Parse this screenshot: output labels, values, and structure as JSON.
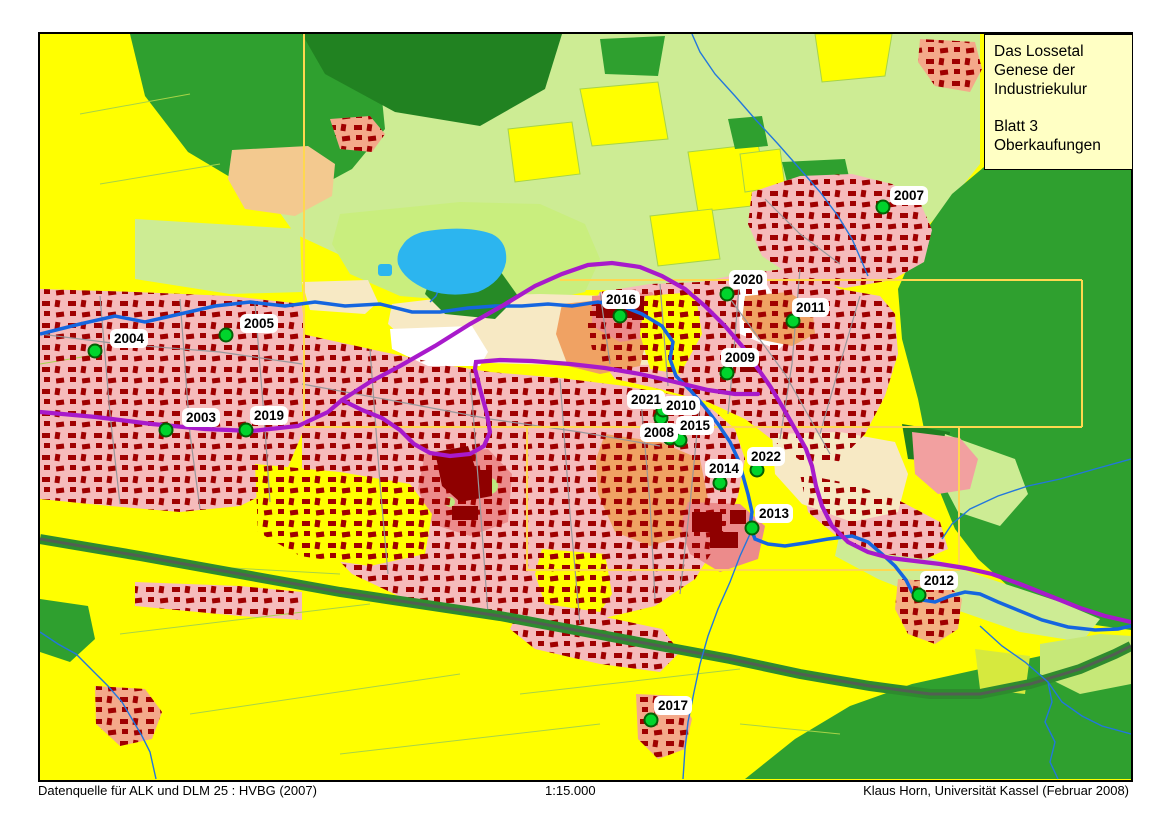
{
  "title_box": {
    "line1": "Das Lossetal",
    "line2": "Genese der",
    "line3": "Industriekulur",
    "line4": "Blatt 3",
    "line5": "Oberkaufungen"
  },
  "footer": {
    "datasource": "Datenquelle für ALK und DLM 25 : HVBG (2007)",
    "scale": "1:15.000",
    "credit": "Klaus Horn, Universität Kassel (Februar 2008)"
  },
  "map": {
    "colors": {
      "field_yellow": "#ffff00",
      "meadow_light_green": "#cdec94",
      "forest_green": "#2fa02f",
      "dark_forest_green": "#218221",
      "settlement_pink": "#f6bbbb",
      "industrial_salmon": "#ec8b8b",
      "old_core_orange": "#f0a263",
      "open_cream": "#f7e9c4",
      "building_red": "#a00000",
      "water_blue": "#1566df",
      "lake_cyan": "#2cb5ef",
      "road_purple": "#a81acb",
      "railway_gray": "#525f52",
      "neatline_gold": "#ffd84f",
      "marker_fill": "#00d42c",
      "marker_border": "#045f04",
      "title_bg": "#ffffc4"
    },
    "markers": [
      {
        "label": "2003",
        "x": 126,
        "y": 396,
        "lx": 142,
        "ly": 374
      },
      {
        "label": "2004",
        "x": 55,
        "y": 317,
        "lx": 70,
        "ly": 295
      },
      {
        "label": "2005",
        "x": 186,
        "y": 301,
        "lx": 200,
        "ly": 280
      },
      {
        "label": "2007",
        "x": 843,
        "y": 173,
        "lx": 850,
        "ly": 152
      },
      {
        "label": "2008",
        "x": 630,
        "y": 404,
        "lx": 600,
        "ly": 389
      },
      {
        "label": "2009",
        "x": 687,
        "y": 339,
        "lx": 681,
        "ly": 314
      },
      {
        "label": "2010",
        "x": 621,
        "y": 384,
        "lx": 622,
        "ly": 362
      },
      {
        "label": "2011",
        "x": 753,
        "y": 287,
        "lx": 752,
        "ly": 264
      },
      {
        "label": "2012",
        "x": 879,
        "y": 561,
        "lx": 880,
        "ly": 537
      },
      {
        "label": "2013",
        "x": 712,
        "y": 494,
        "lx": 715,
        "ly": 470
      },
      {
        "label": "2014",
        "x": 680,
        "y": 449,
        "lx": 665,
        "ly": 425
      },
      {
        "label": "2015",
        "x": 640,
        "y": 406,
        "lx": 636,
        "ly": 382
      },
      {
        "label": "2016",
        "x": 580,
        "y": 282,
        "lx": 562,
        "ly": 256
      },
      {
        "label": "2017",
        "x": 611,
        "y": 686,
        "lx": 614,
        "ly": 662
      },
      {
        "label": "2019",
        "x": 206,
        "y": 396,
        "lx": 210,
        "ly": 372
      },
      {
        "label": "2020",
        "x": 687,
        "y": 260,
        "lx": 689,
        "ly": 236
      },
      {
        "label": "2021",
        "x": 623,
        "y": 376,
        "lx": 587,
        "ly": 356
      },
      {
        "label": "2022",
        "x": 717,
        "y": 436,
        "lx": 707,
        "ly": 413
      }
    ]
  }
}
